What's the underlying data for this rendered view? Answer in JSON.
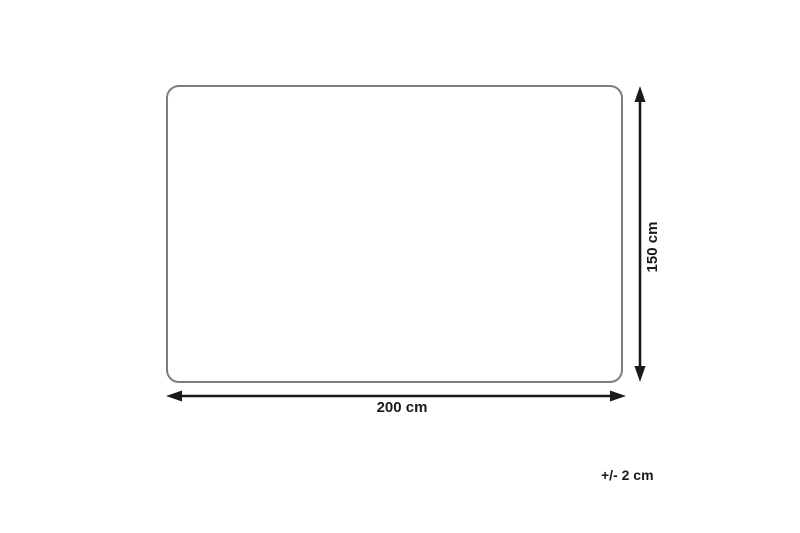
{
  "diagram": {
    "kind": "product-dimension-diagram",
    "width_label": "200 cm",
    "height_label": "150 cm",
    "tolerance_label": "+/- 2 cm",
    "width_cm": 200,
    "height_cm": 150,
    "tolerance_cm": 2
  },
  "colors": {
    "background": "#ffffff",
    "outline": "#7d7d7d",
    "outline_fill": "#ffffff",
    "arrow": "#1a1a1a",
    "text": "#1a1a1a"
  }
}
